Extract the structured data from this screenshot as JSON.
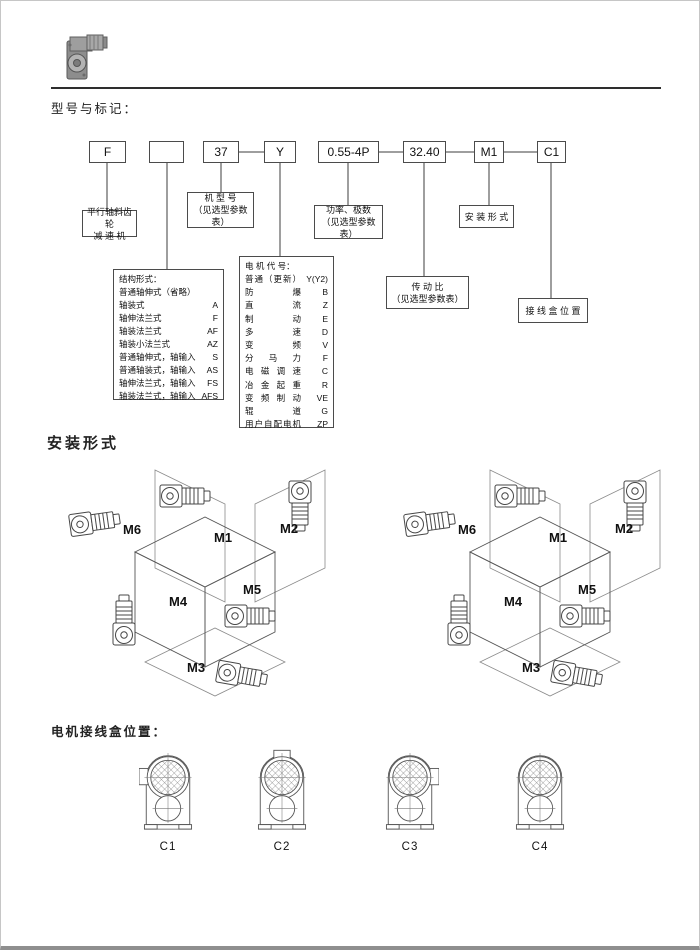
{
  "page": {
    "model_heading": "型号与标记：",
    "mounting_heading": "安装形式",
    "junction_heading": "电机接线盒位置："
  },
  "code_row": [
    "F",
    "",
    "37",
    "Y",
    "0.55-4P",
    "32.40",
    "M1",
    "C1"
  ],
  "callouts": {
    "reducer_line1": "平行轴斜齿轮",
    "reducer_line2": "减 速 机",
    "model_line1": "机 型 号",
    "model_line2": "（见选型参数表）",
    "power_line1": "功率、极数",
    "power_line2": "（见选型参数表）",
    "mounting_label": "安 装 形 式",
    "ratio_line1": "传 动 比",
    "ratio_line2": "（见选型参数表）",
    "junction_label": "接 线 盒 位 置"
  },
  "structure_box": {
    "title": "结构形式：",
    "rows": [
      {
        "name": "普通轴伸式（省略）",
        "code": ""
      },
      {
        "name": "轴装式",
        "code": "A"
      },
      {
        "name": "轴伸法兰式",
        "code": "F"
      },
      {
        "name": "轴装法兰式",
        "code": "AF"
      },
      {
        "name": "轴装小法兰式",
        "code": "AZ"
      },
      {
        "name": "普通轴伸式，轴输入",
        "code": "S"
      },
      {
        "name": "普通轴装式，轴输入",
        "code": "AS"
      },
      {
        "name": "轴伸法兰式，轴输入",
        "code": "FS"
      },
      {
        "name": "轴装法兰式，轴输入",
        "code": "AFS"
      }
    ]
  },
  "motor_box": {
    "title": "电 机 代 号：",
    "rows": [
      {
        "name": "普通（更新）",
        "code": "Y(Y2)"
      },
      {
        "name": "防爆",
        "code": "B"
      },
      {
        "name": "直流",
        "code": "Z"
      },
      {
        "name": "制动",
        "code": "E"
      },
      {
        "name": "多速",
        "code": "D"
      },
      {
        "name": "变频",
        "code": "V"
      },
      {
        "name": "分马力",
        "code": "F"
      },
      {
        "name": "电磁调速",
        "code": "C"
      },
      {
        "name": "冶金起重",
        "code": "R"
      },
      {
        "name": "变频制动",
        "code": "VE"
      },
      {
        "name": "辊道",
        "code": "G"
      },
      {
        "name": "用户自配电机",
        "code": "ZP"
      }
    ]
  },
  "mounting_positions": {
    "m1": "M1",
    "m2": "M2",
    "m3": "M3",
    "m4": "M4",
    "m5": "M5",
    "m6": "M6"
  },
  "junction_labels": [
    "C1",
    "C2",
    "C3",
    "C4"
  ]
}
